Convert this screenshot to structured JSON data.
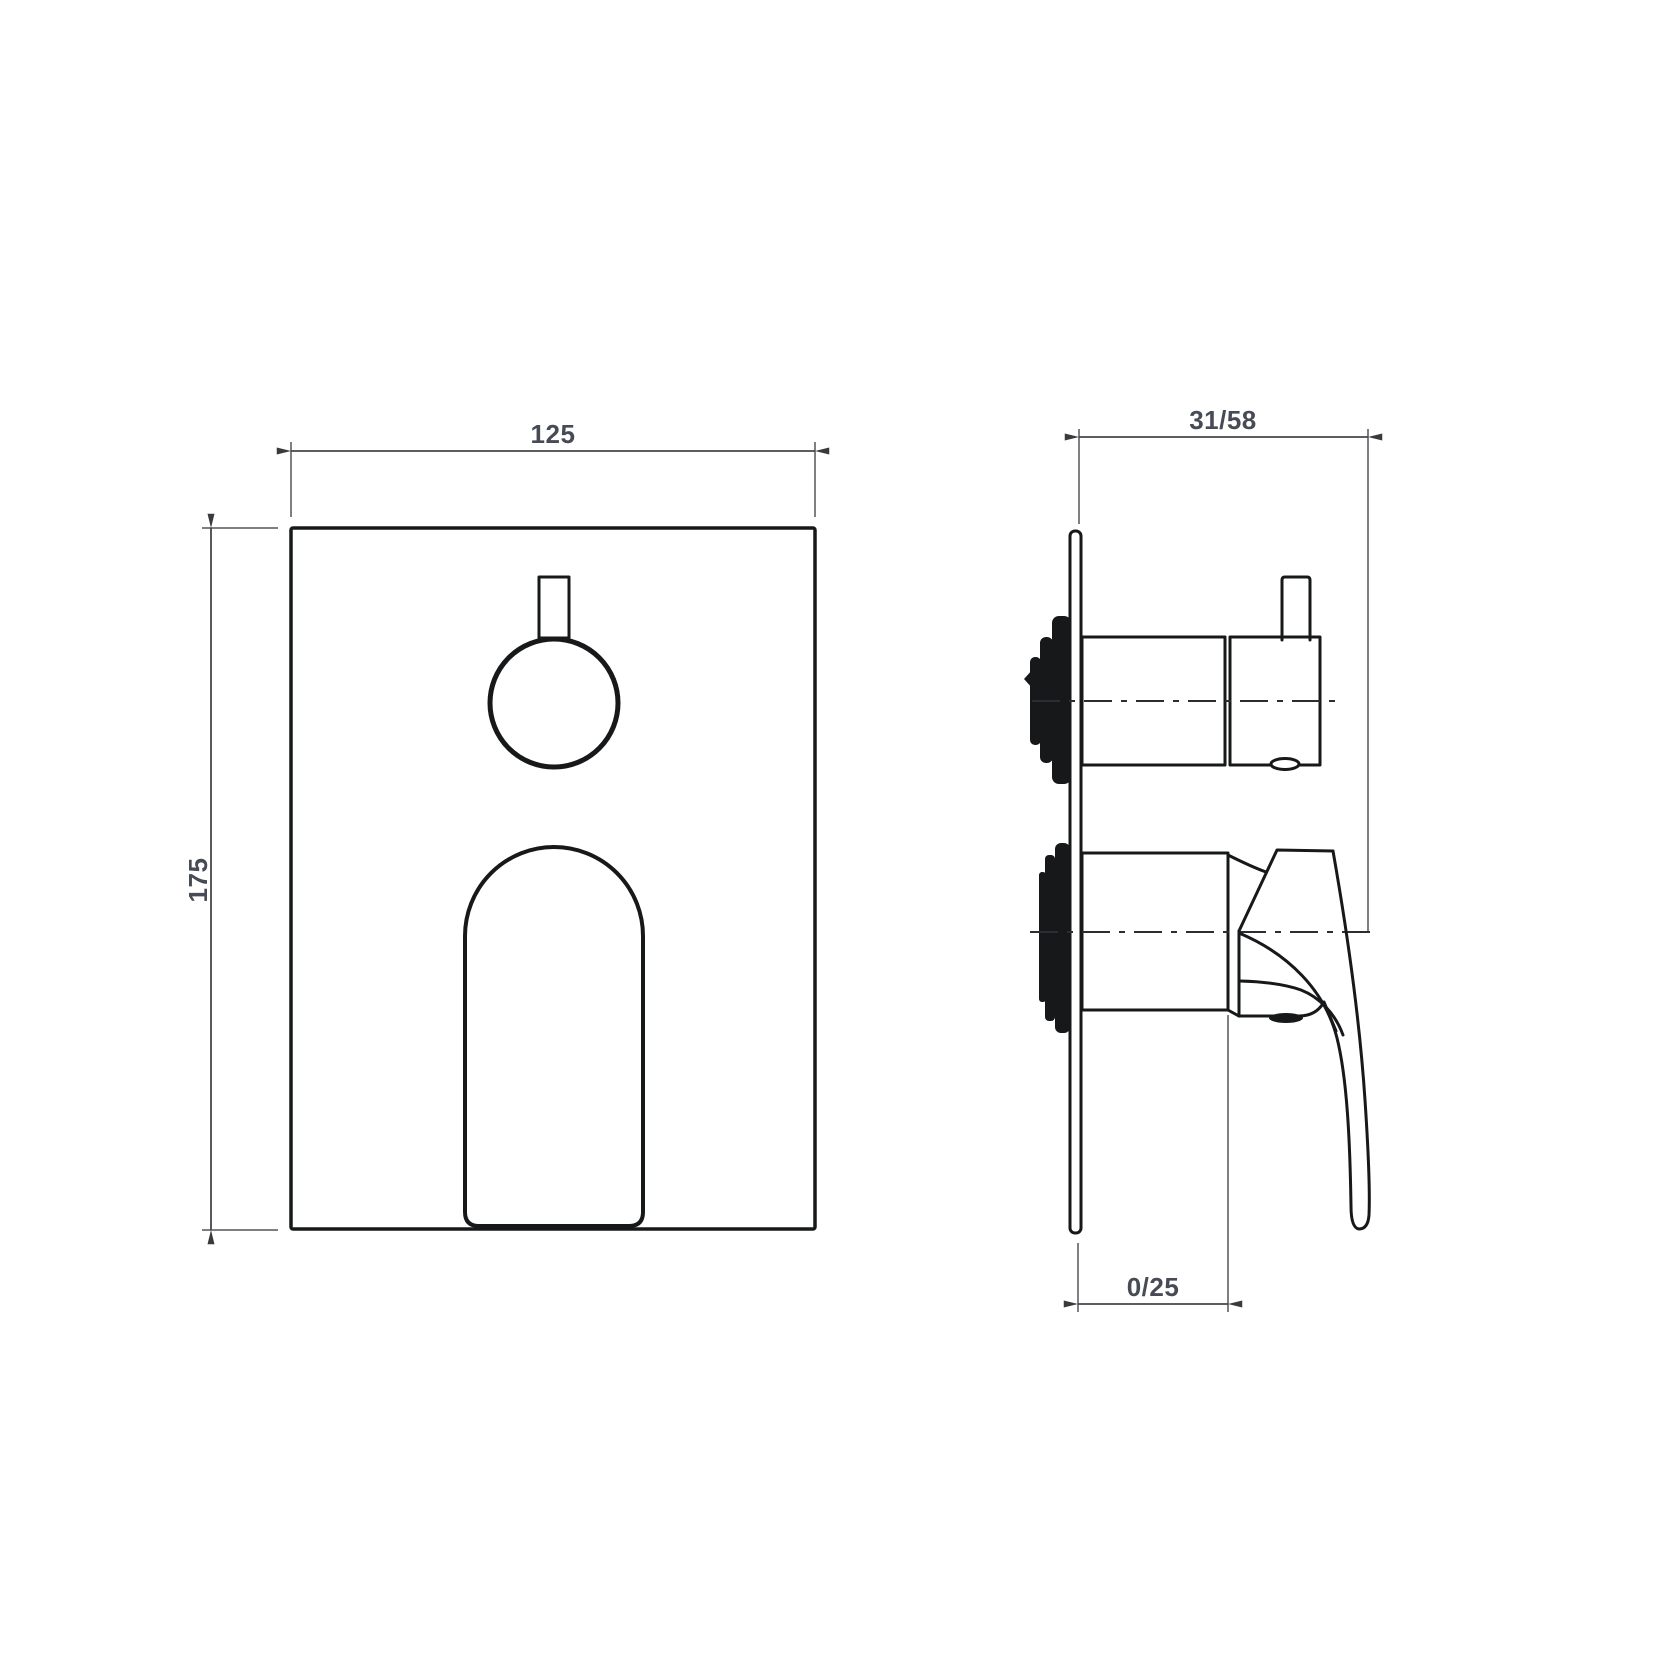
{
  "drawing": {
    "kind": "technical-drawing-two-views",
    "dimension_labels": {
      "front_width": "125",
      "front_height": "175",
      "side_depth_range": "31/58",
      "side_plate_projection_range": "0/25"
    },
    "colors": {
      "outline": "#17181a",
      "dimension_line": "#46464a",
      "dimension_text": "#474b55",
      "background": "#ffffff"
    }
  }
}
